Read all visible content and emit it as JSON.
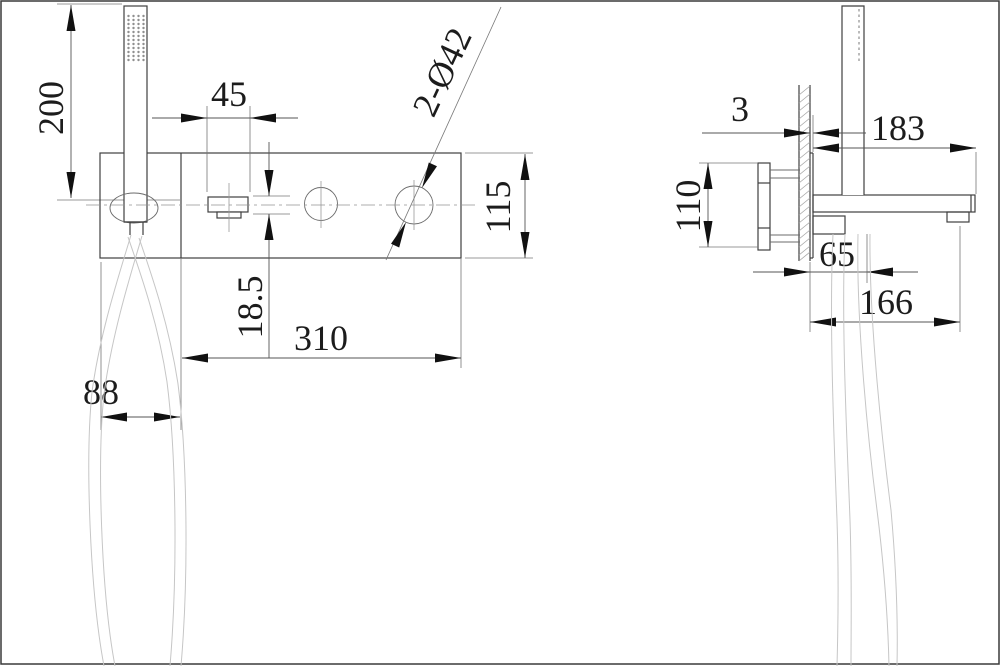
{
  "front_view": {
    "dim_shower_height": "200",
    "dim_handle_width": "45",
    "dim_center_offset": "18.5",
    "dim_plate_length": "310",
    "dim_bracket_width": "88",
    "dim_plate_height": "115",
    "hole_callout": "2-Ø42"
  },
  "side_view": {
    "dim_plate_thickness": "3",
    "dim_spout_reach": "183",
    "dim_inlet_spacing": "110",
    "dim_hose_outlet_offset": "65",
    "dim_spout_outlet_offset": "166"
  }
}
